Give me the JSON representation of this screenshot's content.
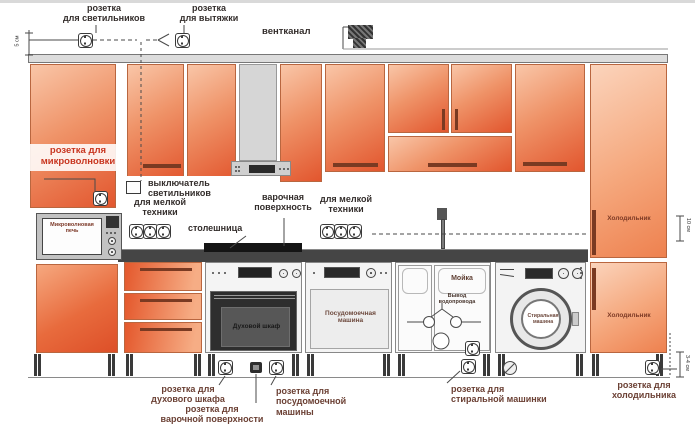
{
  "colors": {
    "cabinet_light": "#f9c6a8",
    "cabinet_dark": "#e2562e",
    "fridge_light": "#fbd4bc",
    "fridge_dark": "#ee814f",
    "countertop": "#454545",
    "red_label": "#c8351f",
    "dark_label": "#332d2b",
    "brown_label": "#6b4034"
  },
  "top": {
    "outlet_lights": [
      "розетка",
      "для светильников"
    ],
    "outlet_hood": [
      "розетка",
      "для вытяжки"
    ],
    "vent_channel": "вентканал"
  },
  "wall": {
    "outlet_microwave": [
      "розетка для",
      "микроволновки"
    ],
    "light_switch": [
      "выключатель",
      "светильников"
    ],
    "small_appliances_left": [
      "для мелкой",
      "техники"
    ],
    "cooktop": [
      "варочная",
      "поверхность"
    ],
    "countertop": "столешница",
    "small_appliances_right": [
      "для мелкой",
      "техники"
    ]
  },
  "appliances": {
    "microwave": [
      "Микроволновая",
      "печь"
    ],
    "oven": "Духовой шкаф",
    "dishwasher": [
      "Посудомоечная",
      "машина"
    ],
    "sink": "Мойка",
    "water_supply": [
      "Вывод",
      "водопровода"
    ],
    "washer": [
      "Стиральная",
      "машина"
    ],
    "fridge_top": "Холодильник",
    "fridge_bottom": "Холодильник"
  },
  "bottom": {
    "outlet_oven": [
      "розетка для",
      "духового шкафа"
    ],
    "outlet_cooktop": [
      "розетка для",
      "варочной поверхности"
    ],
    "outlet_dishwasher": [
      "розетка для",
      "посудомоечной",
      "машины"
    ],
    "outlet_washer": [
      "розетка для",
      "стиральной машинки"
    ],
    "outlet_fridge": [
      "розетка для",
      "холодильника"
    ]
  },
  "dimensions": {
    "left": "5 см",
    "right_top": "10 см",
    "right_bottom": "3-4 см"
  }
}
